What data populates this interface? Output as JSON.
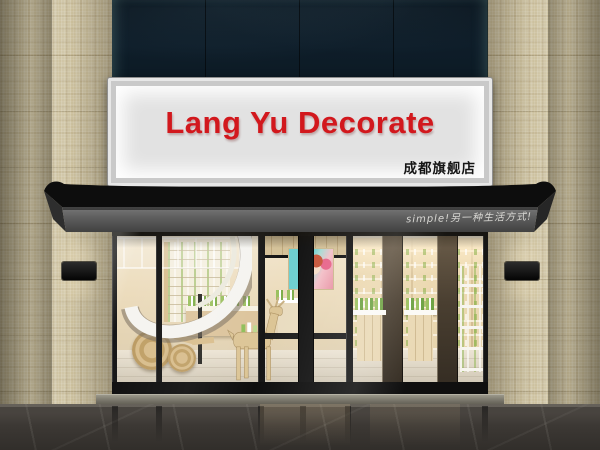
{
  "scene": {
    "description": "Exterior render of a cosmetics flagship storefront",
    "signboard": {
      "title": "Lang Yu Decorate",
      "branch_label": "成都旗舰店",
      "title_color": "#d2181d",
      "branch_color": "#151515",
      "panel_color": "#e2e2e2"
    },
    "awning": {
      "slogan": "simple!另一种生活方式!",
      "slogan_color": "#e6e5e1",
      "canopy_color": "#0d0d0d",
      "fascia_color": "#5c5c5c"
    },
    "facade": {
      "upper_glass_color": "#0d1b26",
      "pillar_tile_color": "#cfc5a6",
      "outer_wall_color": "#a89e82",
      "threshold_color": "#716e63",
      "floor_color": "#3c3834",
      "wall_lamp_count": 2
    },
    "interior": {
      "wall_color": "#ecdcbd",
      "shelf_color": "#f4eedc",
      "product_accent_color": "#8fbf5a",
      "elements": [
        "spiral-staircase",
        "product-wall-shelves",
        "white-display-tables",
        "wooden-deer-sculpture",
        "woven-floor-discs",
        "beauty-poster",
        "glass-double-door"
      ]
    }
  }
}
